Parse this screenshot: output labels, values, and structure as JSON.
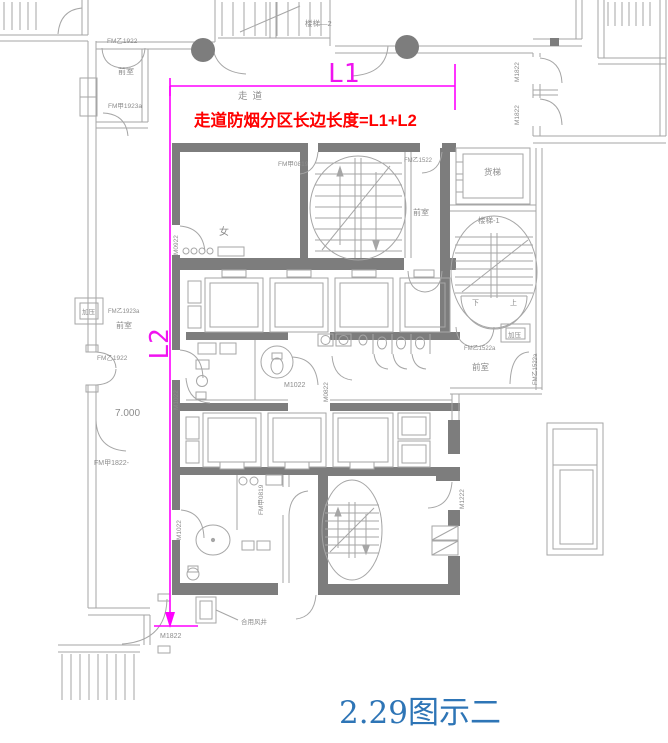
{
  "figure": {
    "caption": "2.29图示二",
    "note_red": "走道防烟分区长边长度=L1+L2",
    "dim_l1": "L1",
    "dim_l2": "L2",
    "corridor": "走道"
  },
  "labels": {
    "qianshi": "前室",
    "nv": "女",
    "huoti": "货梯",
    "louti1": "楼梯-1",
    "louti2": "楼梯—2",
    "jiaya": "加压",
    "xia": "下",
    "shang": "上",
    "elevation": "7.000",
    "heyongfengjing": "合用风井",
    "fm_yi_1922": "FM乙1922",
    "fm_jia_1923a": "FM甲1923a",
    "fm_yi_1923a": "FM乙1923a",
    "fm_jia_0819": "FM甲0819",
    "fm_yi_1522": "FM乙1522",
    "fm_yi_1522a": "FM乙1522a",
    "fm_jia_1822": "FM甲1822-",
    "m0922": "M0922",
    "m1022": "M1022",
    "m0822": "M0822",
    "m1222": "M1222",
    "m1822": "M1822"
  },
  "colors": {
    "dimension": "#FF00FF",
    "note": "#FF0000",
    "caption": "#2E75B6",
    "wall": "#7D7D7D",
    "line": "#A6A6A6",
    "label": "#8C8C8C"
  }
}
